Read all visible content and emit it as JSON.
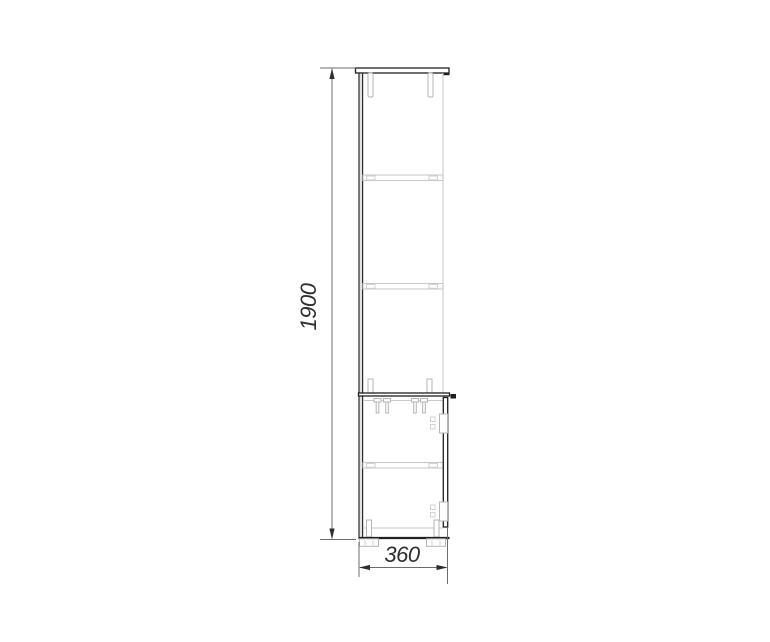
{
  "drawing": {
    "dimensions": {
      "height": {
        "label": "1900"
      },
      "depth": {
        "label": "360"
      }
    },
    "colors": {
      "background": "#ffffff",
      "outline_dark": "#1f1f1f",
      "outline_light": "#c9c9c9",
      "hardware_gray": "#b5b5b5",
      "dimension_line": "#6b6b6b",
      "dimension_text": "#2e2e2e"
    }
  }
}
